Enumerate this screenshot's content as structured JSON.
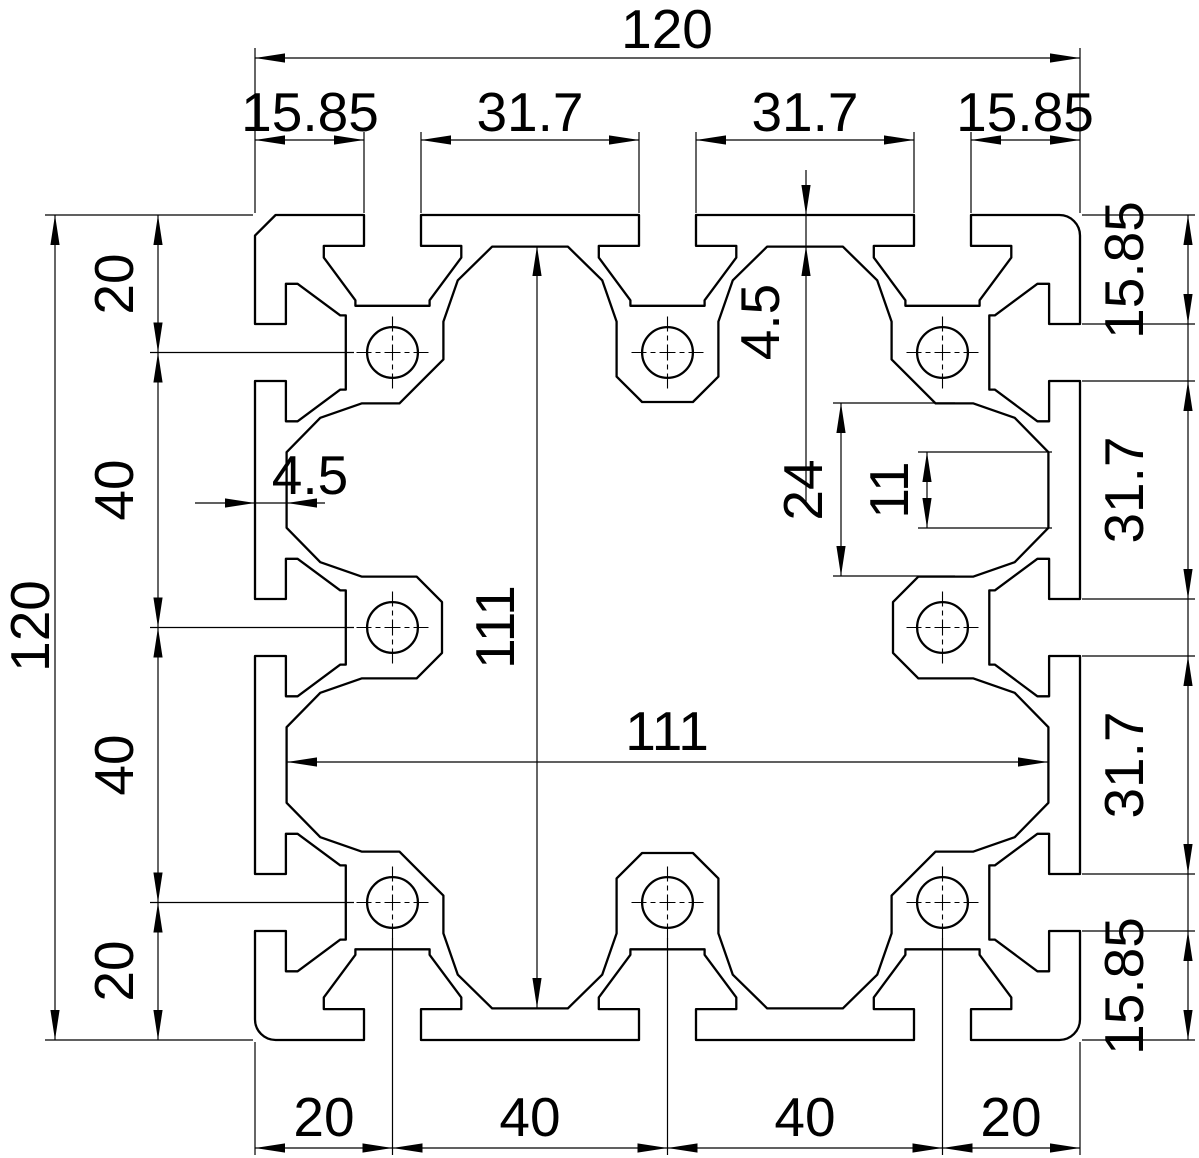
{
  "page": {
    "background": "#ffffff",
    "line_color": "#000000"
  },
  "dims": {
    "top": {
      "total": "120",
      "segments": [
        "15.85",
        "31.7",
        "31.7",
        "15.85"
      ],
      "lip_depth": "4.5"
    },
    "left": {
      "total": "120",
      "chain": [
        "20",
        "40",
        "40",
        "20"
      ],
      "lip_depth": "4.5"
    },
    "right": {
      "chain": [
        "15.85",
        "31.7",
        "31.7",
        "15.85"
      ],
      "boss_gap": "24",
      "rib_width": "11"
    },
    "bottom": {
      "chain": [
        "20",
        "40",
        "40",
        "20"
      ]
    },
    "core": {
      "width": "111",
      "height": "111"
    }
  }
}
